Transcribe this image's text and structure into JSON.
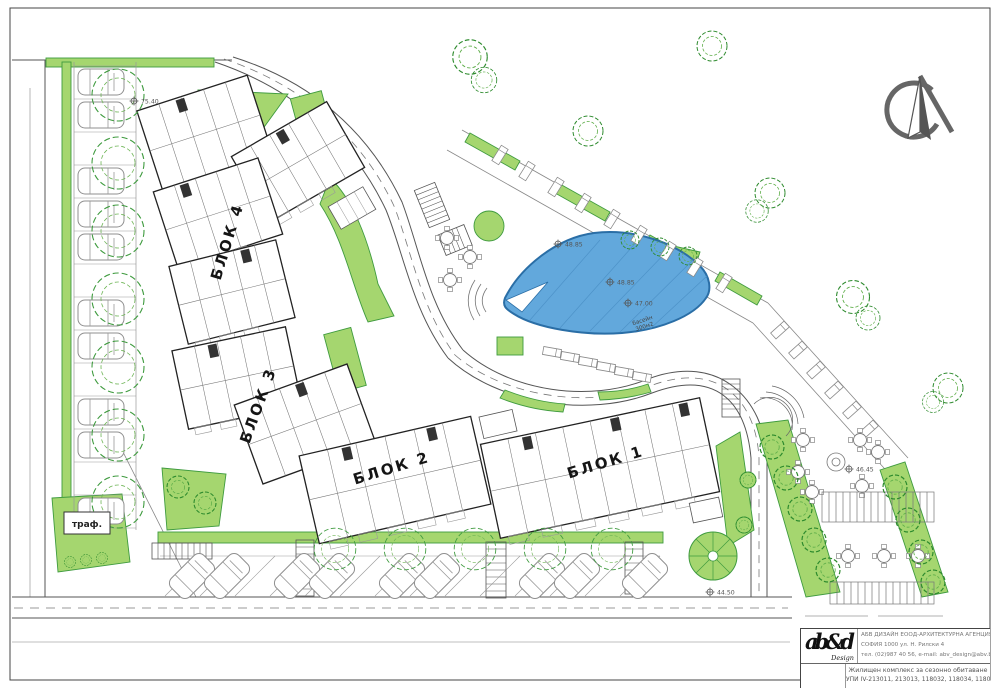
{
  "page": {
    "background": "#ffffff",
    "frame_color": "#444444"
  },
  "plan": {
    "colors": {
      "green_fill": "#a5d66f",
      "green_stroke": "#3f9b3f",
      "tree_stroke": "#2e8b2e",
      "pool_fill": "#62a8dc",
      "pool_stroke": "#2a6ea6",
      "building_line": "#222222",
      "road_line": "#555555"
    },
    "block_labels": [
      {
        "text": "БЛОК 1"
      },
      {
        "text": "БЛОК 2"
      },
      {
        "text": "БЛОК 3"
      },
      {
        "text": "БЛОК 4"
      }
    ],
    "transformer_label": "траф.",
    "pool_label_line1": "басейн",
    "pool_label_line2": "300м2",
    "elevation_markers": [
      {
        "value": "75.40"
      },
      {
        "value": "48.85"
      },
      {
        "value": "48.85"
      },
      {
        "value": "47.00"
      },
      {
        "value": "46.45"
      },
      {
        "value": "44.50"
      }
    ]
  },
  "title_block": {
    "agency_line1": "АБВ ДИЗАЙН ЕООД-АРХИТЕКТУРНА АГЕНЦИЯ",
    "agency_line2": "СОФИЯ 1000 ул. Н. Рилски 4",
    "agency_line3": "тел. (02)987 40 56, e-mail: abv_design@abv.bg",
    "project_line1": "Жилищен комплекс за сезонно обитаване",
    "project_line2": "УПИ IV-213011, 213013, 118032, 118034, 118035",
    "logo_text": "ab&d",
    "logo_script": "Design"
  }
}
